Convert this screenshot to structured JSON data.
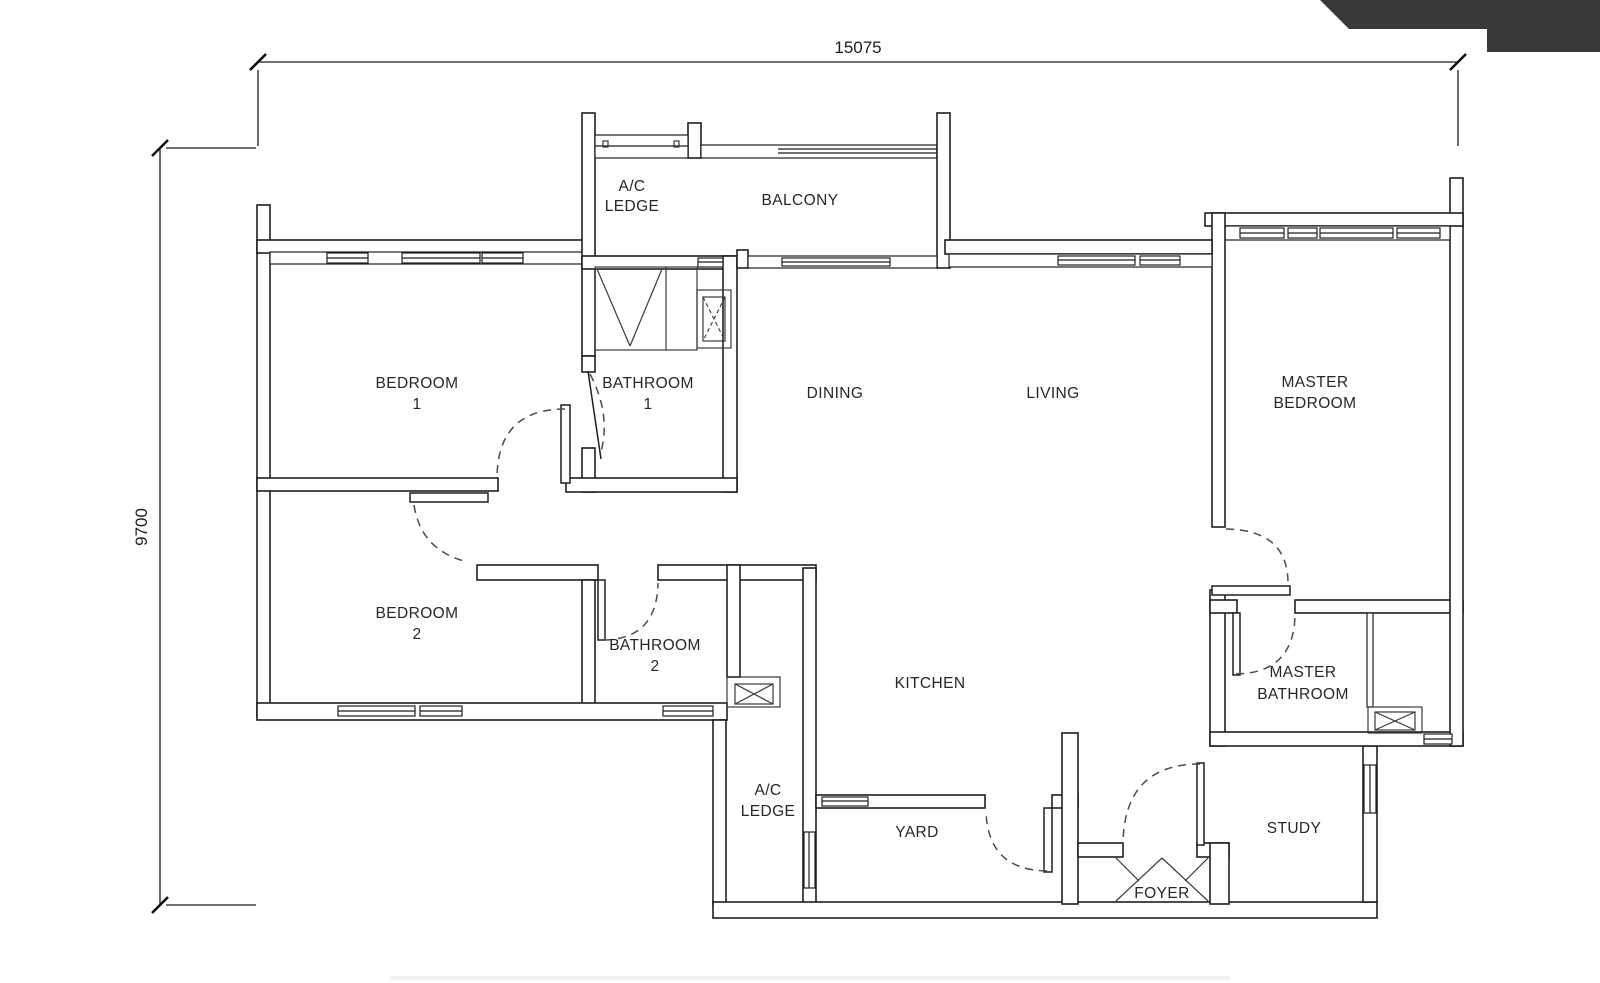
{
  "drawing": {
    "type": "floor-plan",
    "dimensions": {
      "width_label": "15075",
      "height_label": "9700"
    },
    "rooms": [
      {
        "id": "ac-ledge-top",
        "lines": [
          "A/C",
          "LEDGE"
        ]
      },
      {
        "id": "balcony",
        "lines": [
          "BALCONY"
        ]
      },
      {
        "id": "bedroom-1",
        "lines": [
          "BEDROOM",
          "1"
        ]
      },
      {
        "id": "bathroom-1",
        "lines": [
          "BATHROOM",
          "1"
        ]
      },
      {
        "id": "dining",
        "lines": [
          "DINING"
        ]
      },
      {
        "id": "living",
        "lines": [
          "LIVING"
        ]
      },
      {
        "id": "master-bedroom",
        "lines": [
          "MASTER",
          "BEDROOM"
        ]
      },
      {
        "id": "bedroom-2",
        "lines": [
          "BEDROOM",
          "2"
        ]
      },
      {
        "id": "bathroom-2",
        "lines": [
          "BATHROOM",
          "2"
        ]
      },
      {
        "id": "kitchen",
        "lines": [
          "KITCHEN"
        ]
      },
      {
        "id": "master-bathroom",
        "lines": [
          "MASTER",
          "BATHROOM"
        ]
      },
      {
        "id": "ac-ledge-bottom",
        "lines": [
          "A/C",
          "LEDGE"
        ]
      },
      {
        "id": "yard",
        "lines": [
          "YARD"
        ]
      },
      {
        "id": "study",
        "lines": [
          "STUDY"
        ]
      },
      {
        "id": "foyer",
        "lines": [
          "FOYER"
        ]
      }
    ],
    "colors": {
      "wall_stroke": "#1f1f22",
      "label": "#26262e",
      "dimension": "#1c1c1c",
      "corner_banner": "#39393b"
    }
  }
}
